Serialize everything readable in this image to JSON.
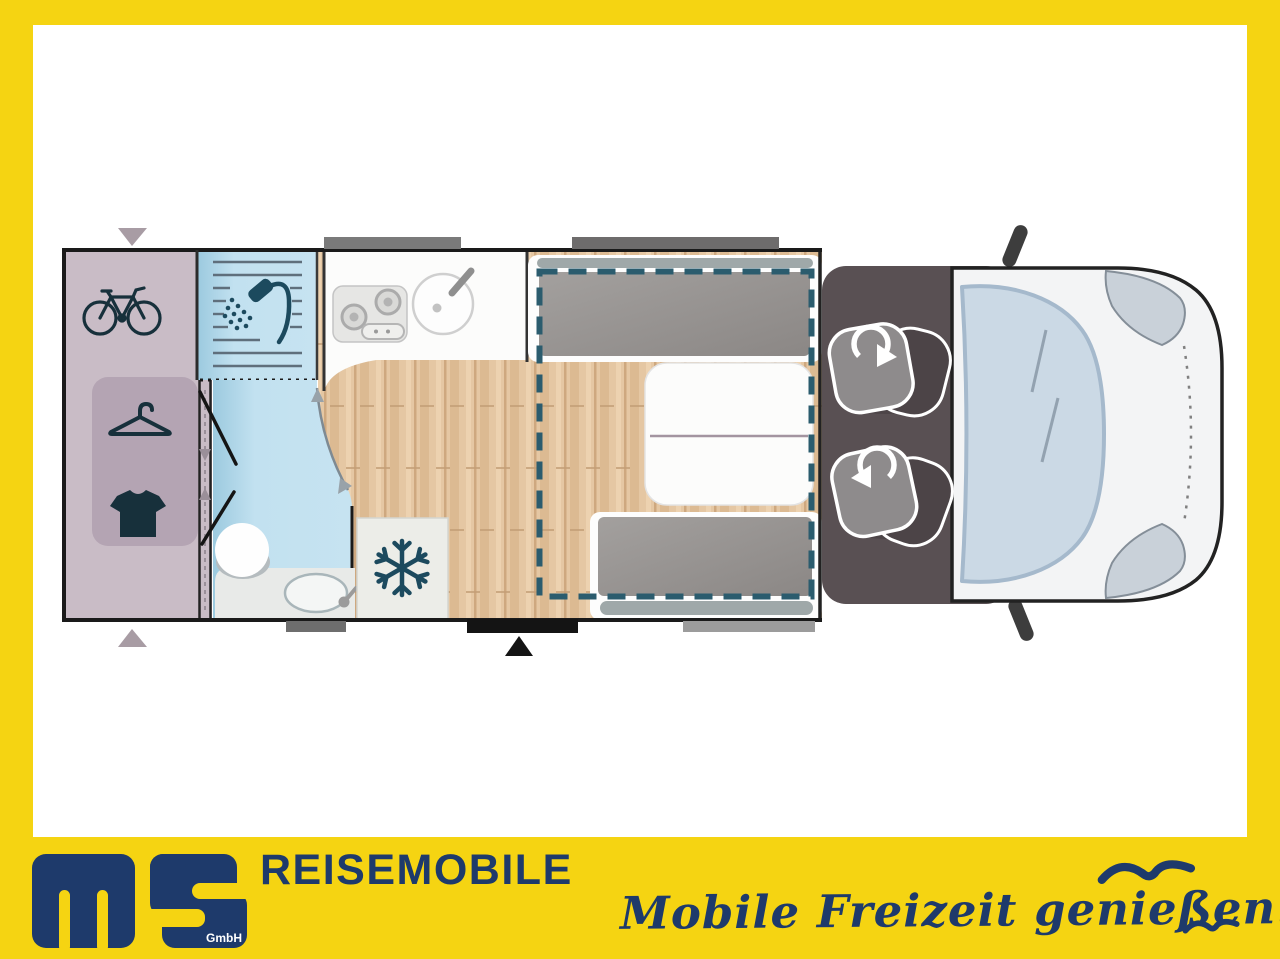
{
  "brand": {
    "logo": "ms",
    "gmbh": "GmbH",
    "company": "REISEMOBILE",
    "tagline": "Mobile Freizeit genießen."
  },
  "colors": {
    "frame_yellow": "#F5D412",
    "brand_navy": "#1E3A6B",
    "garage_mauve": "#C9BCC6",
    "wardrobe_mauve": "#B4A4B3",
    "bath_blue": "#BFE0EF",
    "wood_floor": "#E5C7A3",
    "cushion_gray": "#979392",
    "cab_dark": "#595053",
    "bed_outline_teal": "#2B5C6E",
    "icon_teal": "#1C4A5E",
    "van_body": "#F3F4F5",
    "windshield_blue": "#CBD9E5"
  },
  "floorplan": {
    "type": "motorhome-top-view",
    "areas": [
      {
        "name": "rear-garage",
        "icons": [
          "bicycle-icon",
          "hanger-icon",
          "shirt-icon"
        ]
      },
      {
        "name": "bathroom",
        "icons": [
          "shower-icon",
          "toilet-icon",
          "washbasin-icon"
        ]
      },
      {
        "name": "kitchen",
        "icons": [
          "stove-icon",
          "sink-icon"
        ]
      },
      {
        "name": "fridge",
        "icons": [
          "snowflake-icon"
        ]
      },
      {
        "name": "dinette",
        "features": [
          "bench-seat-top",
          "table",
          "bench-seat-bottom",
          "drop-down-bed-outline"
        ]
      },
      {
        "name": "cab",
        "features": [
          "swivel-seat-left",
          "swivel-seat-right"
        ]
      },
      {
        "name": "vehicle-front",
        "features": [
          "windshield",
          "headlights",
          "side-mirrors"
        ]
      }
    ],
    "openings": [
      "garage-door-top",
      "garage-door-bottom",
      "entry-door",
      "window-kitchen",
      "window-dinette",
      "window-bathroom",
      "window-bench"
    ]
  }
}
